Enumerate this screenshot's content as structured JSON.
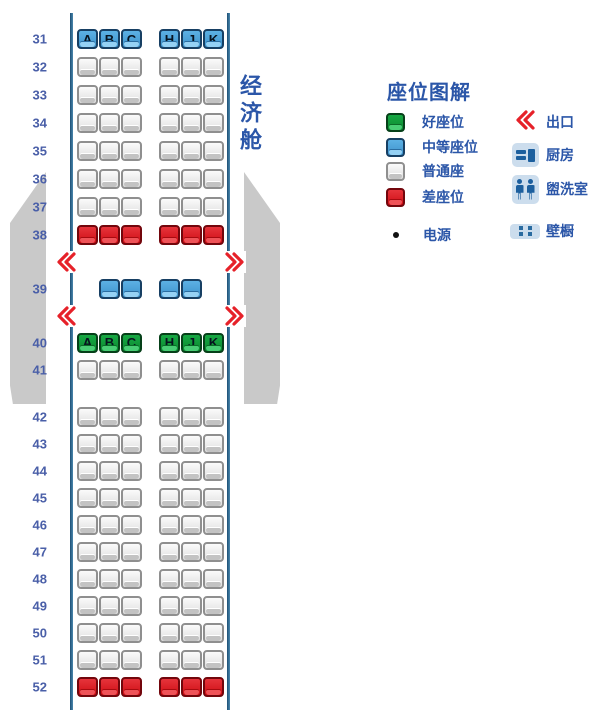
{
  "cabin": {
    "class_label": "经济舱",
    "left_letters": [
      "A",
      "B",
      "C"
    ],
    "right_letters": [
      "H",
      "J",
      "K"
    ],
    "rows": [
      {
        "kind": "row",
        "num": "31",
        "type": "medium",
        "letters": true
      },
      {
        "kind": "row",
        "num": "32",
        "type": "normal"
      },
      {
        "kind": "row",
        "num": "33",
        "type": "normal"
      },
      {
        "kind": "row",
        "num": "34",
        "type": "normal"
      },
      {
        "kind": "row",
        "num": "35",
        "type": "normal"
      },
      {
        "kind": "row",
        "num": "36",
        "type": "normal"
      },
      {
        "kind": "row",
        "num": "37",
        "type": "normal"
      },
      {
        "kind": "row",
        "num": "38",
        "type": "bad"
      },
      {
        "kind": "exit"
      },
      {
        "kind": "row",
        "num": "39",
        "type": "medium",
        "pair": true
      },
      {
        "kind": "exit"
      },
      {
        "kind": "row",
        "num": "40",
        "type": "good",
        "letters": true
      },
      {
        "kind": "row",
        "num": "41",
        "type": "normal"
      },
      {
        "kind": "gap"
      },
      {
        "kind": "row",
        "num": "42",
        "type": "normal"
      },
      {
        "kind": "row",
        "num": "43",
        "type": "normal"
      },
      {
        "kind": "row",
        "num": "44",
        "type": "normal"
      },
      {
        "kind": "row",
        "num": "45",
        "type": "normal"
      },
      {
        "kind": "row",
        "num": "46",
        "type": "normal"
      },
      {
        "kind": "row",
        "num": "47",
        "type": "normal"
      },
      {
        "kind": "row",
        "num": "48",
        "type": "normal"
      },
      {
        "kind": "row",
        "num": "49",
        "type": "normal"
      },
      {
        "kind": "row",
        "num": "50",
        "type": "normal"
      },
      {
        "kind": "row",
        "num": "51",
        "type": "normal"
      },
      {
        "kind": "row",
        "num": "52",
        "type": "bad"
      }
    ]
  },
  "legend": {
    "title": "座位图解",
    "seat_types": [
      {
        "type": "good",
        "label": "好座位",
        "color": "#129a3b"
      },
      {
        "type": "medium",
        "label": "中等座位",
        "color": "#4aa0d8"
      },
      {
        "type": "normal",
        "label": "普通座",
        "color": "#e3e3e3"
      },
      {
        "type": "bad",
        "label": "差座位",
        "color": "#d5141b"
      }
    ],
    "power": {
      "label": "电源"
    },
    "facilities": [
      {
        "type": "exit",
        "label": "出口"
      },
      {
        "type": "galley",
        "label": "厨房"
      },
      {
        "type": "lavatory",
        "label": "盥洗室"
      },
      {
        "type": "closet",
        "label": "壁橱"
      }
    ]
  },
  "colors": {
    "text_blue": "#2b56a8",
    "row_number_blue": "#4a5fa8",
    "exit_red": "#e62129",
    "wing_gray": "#c9c9c9",
    "fuselage_line": "#2f6d96",
    "facility_bg": "#ccdded",
    "facility_glyph": "#1c5f9e",
    "seat_letter": "#07131f"
  }
}
